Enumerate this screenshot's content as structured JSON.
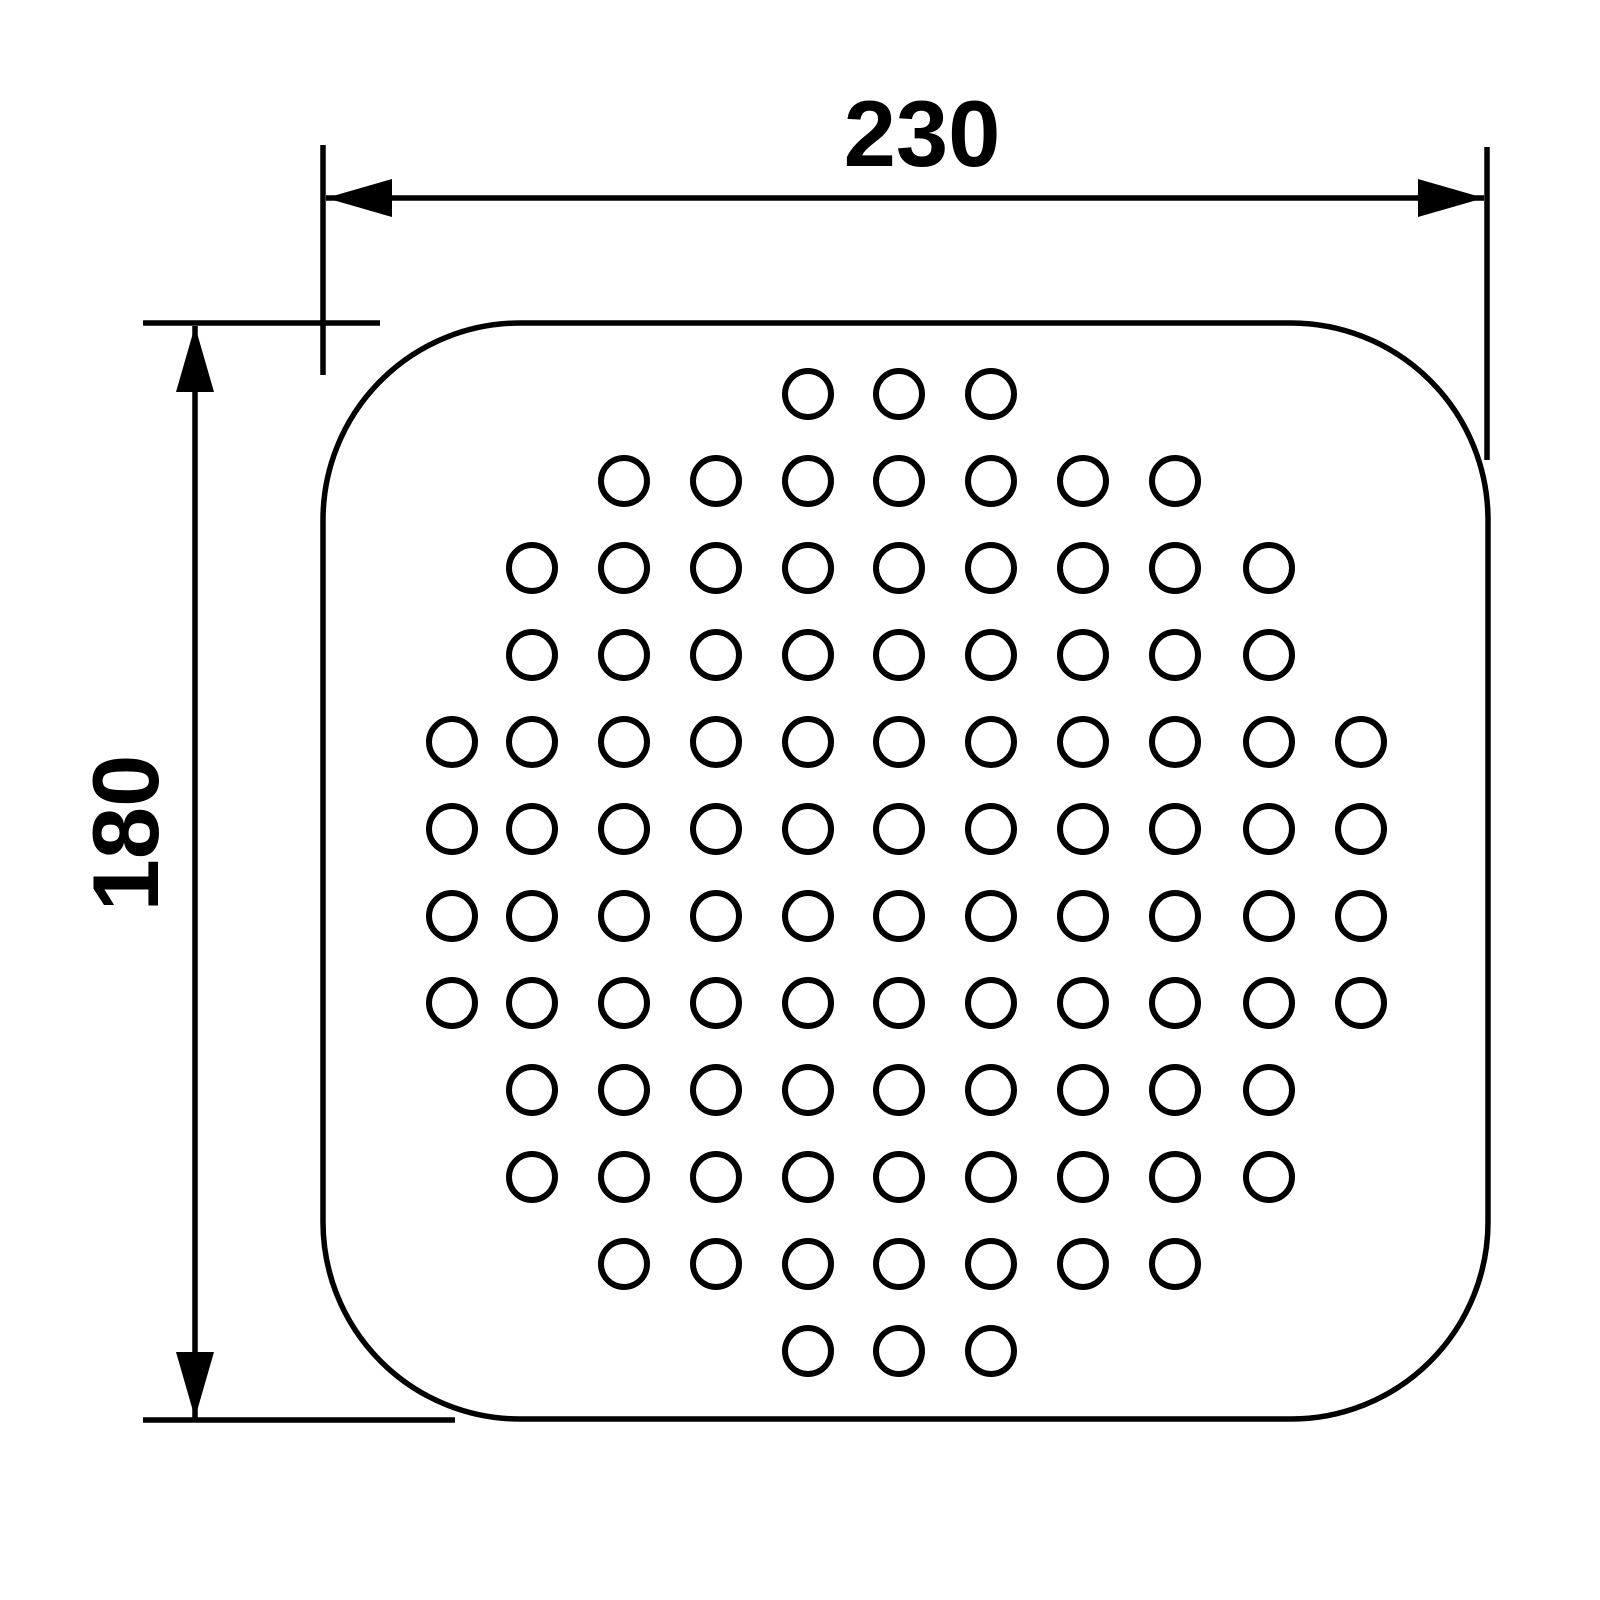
{
  "drawing": {
    "background_color": "#ffffff",
    "line_color": "#000000",
    "line_width": 5.5,
    "dimension_font_size": 94,
    "arrow": {
      "length": 66,
      "half_width": 19
    },
    "plate": {
      "x": 323,
      "y": 323,
      "width": 1165,
      "height": 1096,
      "corner_radius": 197,
      "stroke_width": 5.5
    },
    "holes": {
      "radius": 23,
      "stroke_width": 6,
      "column_x": [
        452,
        532,
        624,
        716,
        808,
        899,
        991,
        1083,
        1175,
        1269,
        1361
      ],
      "row_y": [
        394,
        481,
        568,
        655,
        742,
        829,
        916,
        1003,
        1090,
        1177,
        1264,
        1351
      ],
      "row_columns": [
        [
          4,
          5,
          6
        ],
        [
          2,
          3,
          4,
          5,
          6,
          7,
          8
        ],
        [
          1,
          2,
          3,
          4,
          5,
          6,
          7,
          8,
          9
        ],
        [
          1,
          2,
          3,
          4,
          5,
          6,
          7,
          8,
          9
        ],
        [
          0,
          1,
          2,
          3,
          4,
          5,
          6,
          7,
          8,
          9,
          10
        ],
        [
          0,
          1,
          2,
          3,
          4,
          5,
          6,
          7,
          8,
          9,
          10
        ],
        [
          0,
          1,
          2,
          3,
          4,
          5,
          6,
          7,
          8,
          9,
          10
        ],
        [
          0,
          1,
          2,
          3,
          4,
          5,
          6,
          7,
          8,
          9,
          10
        ],
        [
          1,
          2,
          3,
          4,
          5,
          6,
          7,
          8,
          9
        ],
        [
          1,
          2,
          3,
          4,
          5,
          6,
          7,
          8,
          9
        ],
        [
          2,
          3,
          4,
          5,
          6,
          7,
          8
        ],
        [
          4,
          5,
          6
        ]
      ]
    },
    "width_dimension": {
      "label": "230",
      "dim_line": {
        "x1": 326,
        "y1": 198,
        "x2": 1484,
        "y2": 198
      },
      "extension_lines": [
        {
          "x1": 323,
          "y1": 145,
          "x2": 323,
          "y2": 375
        },
        {
          "x1": 1487,
          "y1": 147,
          "x2": 1487,
          "y2": 460
        }
      ],
      "arrows": [
        {
          "tip_x": 326,
          "tip_y": 198,
          "axis": "h",
          "base_dir": 1
        },
        {
          "tip_x": 1484,
          "tip_y": 198,
          "axis": "h",
          "base_dir": -1
        }
      ],
      "label_x": 922,
      "label_y": 166,
      "label_rotation": 0
    },
    "height_dimension": {
      "label": "180",
      "dim_line": {
        "x1": 195,
        "y1": 326,
        "x2": 195,
        "y2": 1418
      },
      "extension_lines": [
        {
          "x1": 143,
          "y1": 323,
          "x2": 380,
          "y2": 323
        },
        {
          "x1": 143,
          "y1": 1420,
          "x2": 455,
          "y2": 1420
        }
      ],
      "arrows": [
        {
          "tip_x": 195,
          "tip_y": 326,
          "axis": "v",
          "base_dir": 1
        },
        {
          "tip_x": 195,
          "tip_y": 1418,
          "axis": "v",
          "base_dir": -1
        }
      ],
      "label_x": 158,
      "label_y": 833,
      "label_rotation": -90
    }
  }
}
